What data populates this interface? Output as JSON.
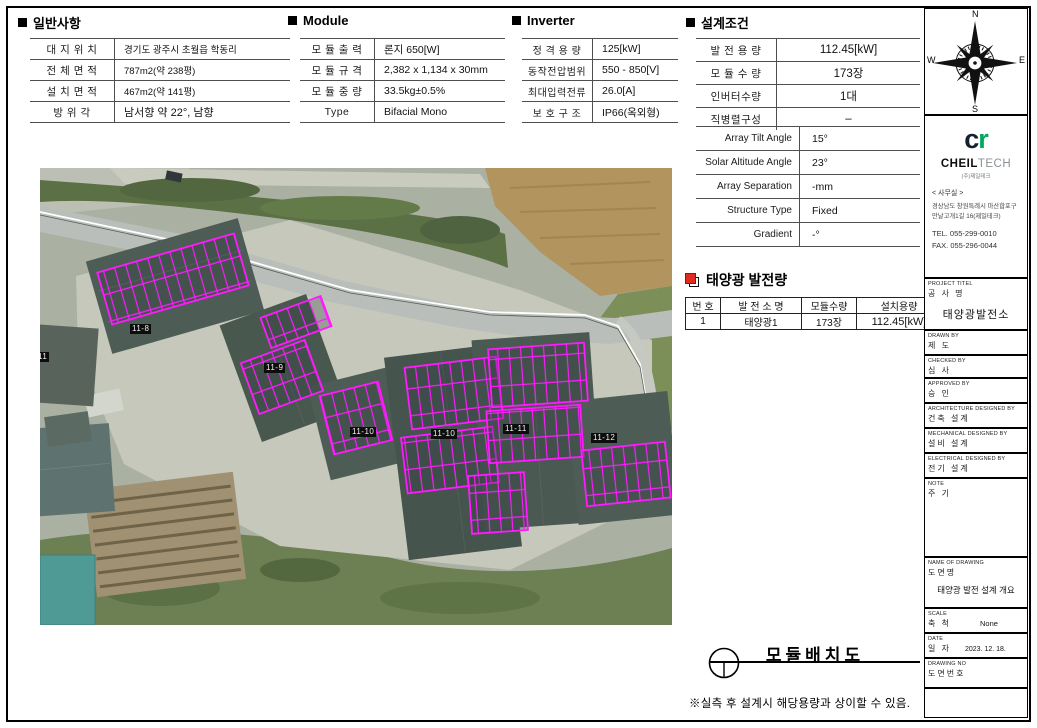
{
  "colors": {
    "panel_magenta": "#ff1aff",
    "logo_green": "#00a85d",
    "title_icon_red": "#e02b20"
  },
  "sections": {
    "general": {
      "title": "일반사항",
      "rows": [
        {
          "label": "대 지 위 치",
          "value": "경기도 광주시 초월읍 학동리"
        },
        {
          "label": "전 체 면 적",
          "value": "787m2(약 238평)"
        },
        {
          "label": "설 치 면 적",
          "value": "467m2(약 141평)"
        },
        {
          "label": "방  위  각",
          "value": "남서향 약 22°, 남향"
        }
      ]
    },
    "module": {
      "title": "Module",
      "rows": [
        {
          "label": "모 듈 출 력",
          "value": "론지 650[W]"
        },
        {
          "label": "모 듈 규 격",
          "value": "2,382 x 1,134 x 30mm"
        },
        {
          "label": "모 듈 중 량",
          "value": "33.5kg±0.5%"
        },
        {
          "label": "Type",
          "value": "Bifacial Mono"
        }
      ]
    },
    "inverter": {
      "title": "Inverter",
      "rows": [
        {
          "label": "정 격 용 량",
          "value": "125[kW]"
        },
        {
          "label": "동작전압범위",
          "value": "550 - 850[V]"
        },
        {
          "label": "최대입력전류",
          "value": "26.0[A]"
        },
        {
          "label": "보 호 구 조",
          "value": "IP66(옥외형)"
        }
      ]
    },
    "design": {
      "title": "설계조건",
      "rows_a": [
        {
          "label": "발 전 용 량",
          "value": "112.45[kW]"
        },
        {
          "label": "모 듈 수 량",
          "value": "173장"
        },
        {
          "label": "인버터수량",
          "value": "1대"
        },
        {
          "label": "직병렬구성",
          "value": "–"
        }
      ],
      "rows_b": [
        {
          "label": "Array Tilt Angle",
          "value": "15°"
        },
        {
          "label": "Solar Altitude Angle",
          "value": "23°"
        },
        {
          "label": "Array Separation",
          "value": "-mm"
        },
        {
          "label": "Structure Type",
          "value": "Fixed"
        },
        {
          "label": "Gradient",
          "value": "-°"
        }
      ]
    },
    "generation": {
      "title": "태양광 발전량",
      "headers": [
        "번 호",
        "발 전 소 명",
        "모듈수량",
        "설치용량"
      ],
      "row": [
        "1",
        "태양광1",
        "173장",
        "112.45[kW]"
      ]
    }
  },
  "map": {
    "labels": [
      "11",
      "11-8",
      "11-9",
      "11-10",
      "11-10",
      "11-11",
      "11-12"
    ]
  },
  "footer": {
    "drawing_title": "모듈배치도",
    "note": "※실측 후 설계시 해당용량과 상이할 수 있음."
  },
  "sidebar": {
    "compass": {
      "n": "N",
      "e": "E",
      "s": "S",
      "w": "W"
    },
    "logo": {
      "mark_c": "c",
      "mark_r": "r",
      "name_bold": "CHEIL",
      "name_light": "TECH",
      "subname": "(주)제일테크"
    },
    "office": {
      "heading": "< 사무실 >",
      "address1": "경상남도 창원특례시 마산합포구",
      "address2": "만날고개1길 16(제일테크)",
      "tel": "TEL. 055-299-0010",
      "fax": "FAX. 055-296-0044"
    },
    "fields": [
      {
        "en": "PROJECT TITEL",
        "ko": "공 사 명",
        "value": "태양광발전소"
      },
      {
        "en": "DRAWN BY",
        "ko": "제 도",
        "value": ""
      },
      {
        "en": "CHECKED BY",
        "ko": "심 사",
        "value": ""
      },
      {
        "en": "APPROVED BY",
        "ko": "승 인",
        "value": ""
      },
      {
        "en": "ARCHITECTURE DESIGNED BY",
        "ko": "건축 설계",
        "value": ""
      },
      {
        "en": "MECHANICAL DESIGNED BY",
        "ko": "설비 설계",
        "value": ""
      },
      {
        "en": "ELECTRICAL DESIGNED BY",
        "ko": "전기 설계",
        "value": ""
      },
      {
        "en": "NOTE",
        "ko": "주 기",
        "value": ""
      },
      {
        "en": "NAME OF DRAWING",
        "ko": "도면명",
        "value": "태양광 발전 설계 개요"
      },
      {
        "en": "SCALE",
        "ko": "축 척",
        "value": "None"
      },
      {
        "en": "DATE",
        "ko": "일 자",
        "value": "2023. 12. 18."
      },
      {
        "en": "DRAWING NO",
        "ko": "도면번호",
        "value": ""
      }
    ]
  }
}
